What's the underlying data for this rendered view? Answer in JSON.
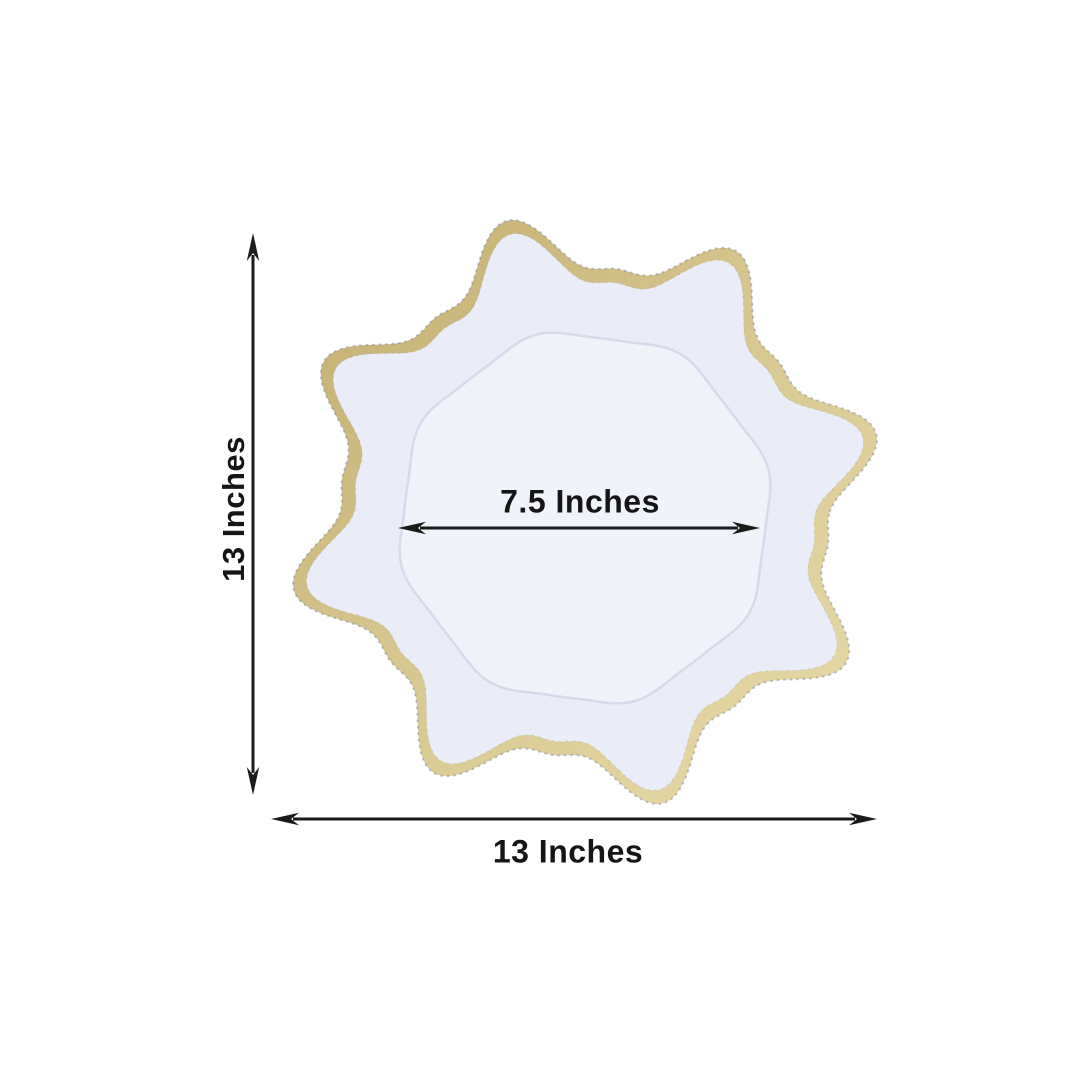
{
  "diagram": {
    "background": "#ffffff",
    "subject": "Scalloped sunflower charger plate with gold wavy rim",
    "dimension_line_color": "#1b1b1b",
    "text_color": "#151515"
  },
  "plate": {
    "rim_gold_dark": "#c3ac6e",
    "rim_gold": "#d6c58e",
    "rim_gold_light": "#e9dcab",
    "rim_edge_dots": "#7b85ad",
    "face": "#eaedf8",
    "well": "#f1f3fb",
    "well_edge": "#c3c9dd"
  },
  "dimensions": {
    "height": {
      "label": "13 Inches"
    },
    "width": {
      "label": "13 Inches"
    },
    "well_diameter": {
      "label": "7.5 Inches"
    }
  }
}
